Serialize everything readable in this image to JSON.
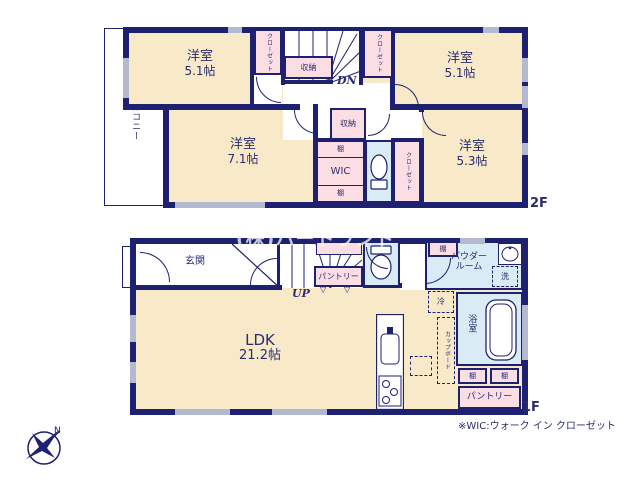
{
  "colors": {
    "wall": "#1e2170",
    "room": "#f8e9c8",
    "pink": "#fadee3",
    "blue": "#d9ecf5",
    "win": "#b4b8d0",
    "text": "#2a2c6e"
  },
  "floor2": {
    "floor_label": "2F",
    "balcony_label": "バルコニー",
    "room_nw_name": "洋室",
    "room_nw_size": "5.1帖",
    "room_ne_name": "洋室",
    "room_ne_size": "5.1帖",
    "room_w_name": "洋室",
    "room_w_size": "7.1帖",
    "room_se_name": "洋室",
    "room_se_size": "5.3帖",
    "closet_nw_label": "クローゼット",
    "closet_n_label": "クローゼット",
    "closet_s_label": "クローゼット",
    "storage_stairs_label": "収納",
    "storage_mid_label": "収納",
    "shelf_top_label": "棚",
    "wic_label": "WIC",
    "shelf_bottom_label": "棚",
    "stairs_dn_label": "DN"
  },
  "floor1": {
    "floor_label": "1F",
    "entrance_label": "玄関",
    "stairs_up_label": "UP",
    "pantry_north_label": "パントリー",
    "powder_shelf_label": "棚",
    "powder_room_line1": "パウダー",
    "powder_room_line2": "ルーム",
    "washer_label": "洗",
    "fridge_label": "冷",
    "cupboard_label": "カップボード",
    "bathroom_label": "浴室",
    "shelf_a_label": "棚",
    "shelf_b_label": "棚",
    "pantry_south_label": "パントリー",
    "ldk_name": "LDK",
    "ldk_size": "21.2帖"
  },
  "annotations": {
    "watermark": "(株)ハートランド",
    "wic_note": "※WIC:ウォーク イン クローゼット",
    "compass_north": "N"
  }
}
